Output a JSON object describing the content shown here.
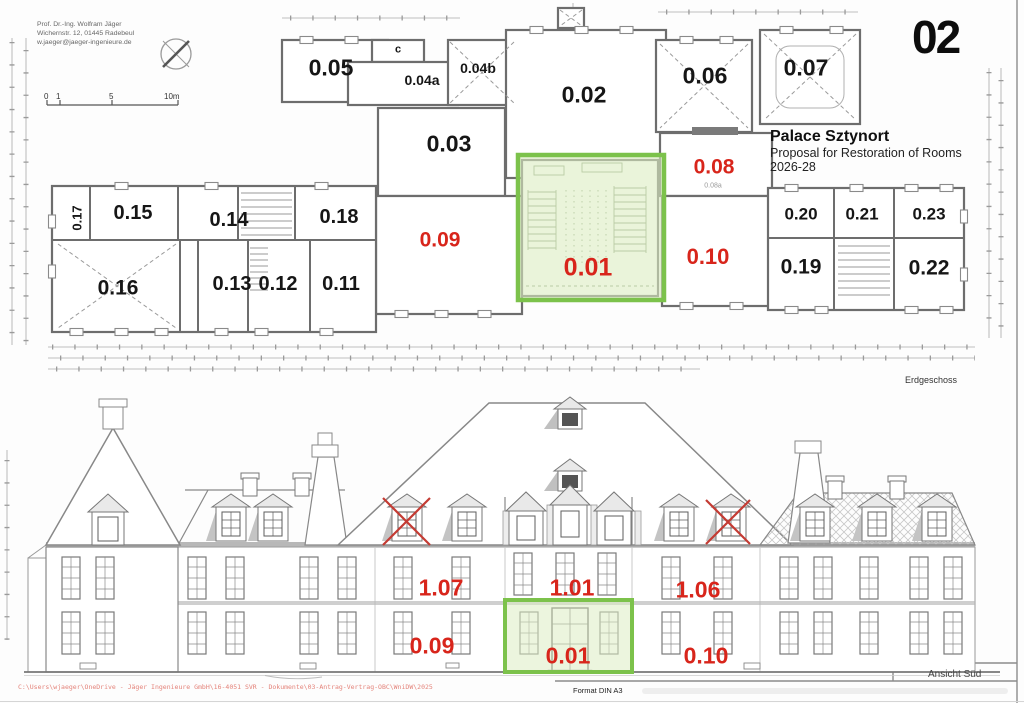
{
  "sheet": {
    "page_number": "02"
  },
  "architect": {
    "line1": "Prof. Dr.-Ing. Wolfram Jäger",
    "line2": "Wichernstr. 12, 01445 Radebeul",
    "line3": "w.jaeger@jaeger-ingenieure.de"
  },
  "scale_bar": {
    "t0": "0",
    "t1": "1",
    "t5": "5",
    "t10": "10m"
  },
  "title_block": {
    "project": "Palace Sztynort",
    "subtitle": "Proposal for Restoration of Rooms",
    "period": "2026-28"
  },
  "floor_plan": {
    "caption": "Erdgeschoss",
    "rooms": {
      "r005": "0.05",
      "rc": "c",
      "r004a": "0.04a",
      "r004b": "0.04b",
      "r002": "0.02",
      "r006": "0.06",
      "r007": "0.07",
      "r003": "0.03",
      "r017": "0.17",
      "r015": "0.15",
      "r014": "0.14",
      "r018": "0.18",
      "r016": "0.16",
      "r013": "0.13",
      "r012": "0.12",
      "r011": "0.11",
      "r020": "0.20",
      "r021": "0.21",
      "r023": "0.23",
      "r019": "0.19",
      "r022": "0.22"
    },
    "rooms_red": {
      "r008": "0.08",
      "r008a": "0.08a",
      "r009": "0.09",
      "r001": "0.01",
      "r010": "0.10"
    }
  },
  "elevation": {
    "caption": "Ansicht Süd",
    "labels": {
      "f107": "1.07",
      "f101": "1.01",
      "f106": "1.06",
      "g009": "0.09",
      "g001": "0.01",
      "g010": "0.10"
    }
  },
  "footer": {
    "file_path": "C:\\Users\\wjaeger\\OneDrive - Jäger Ingenieure GmbH\\16-4051 SVR - Dokumente\\03-Antrag-Vertrag-OBC\\WniDW\\2025",
    "format": "Format DIN A3"
  },
  "colors": {
    "highlight_border": "#7cc24b",
    "highlight_fill": "#dcedc2",
    "label_red": "#d8251b",
    "label_black": "#161616",
    "wall_gray": "#6d6d6d"
  }
}
